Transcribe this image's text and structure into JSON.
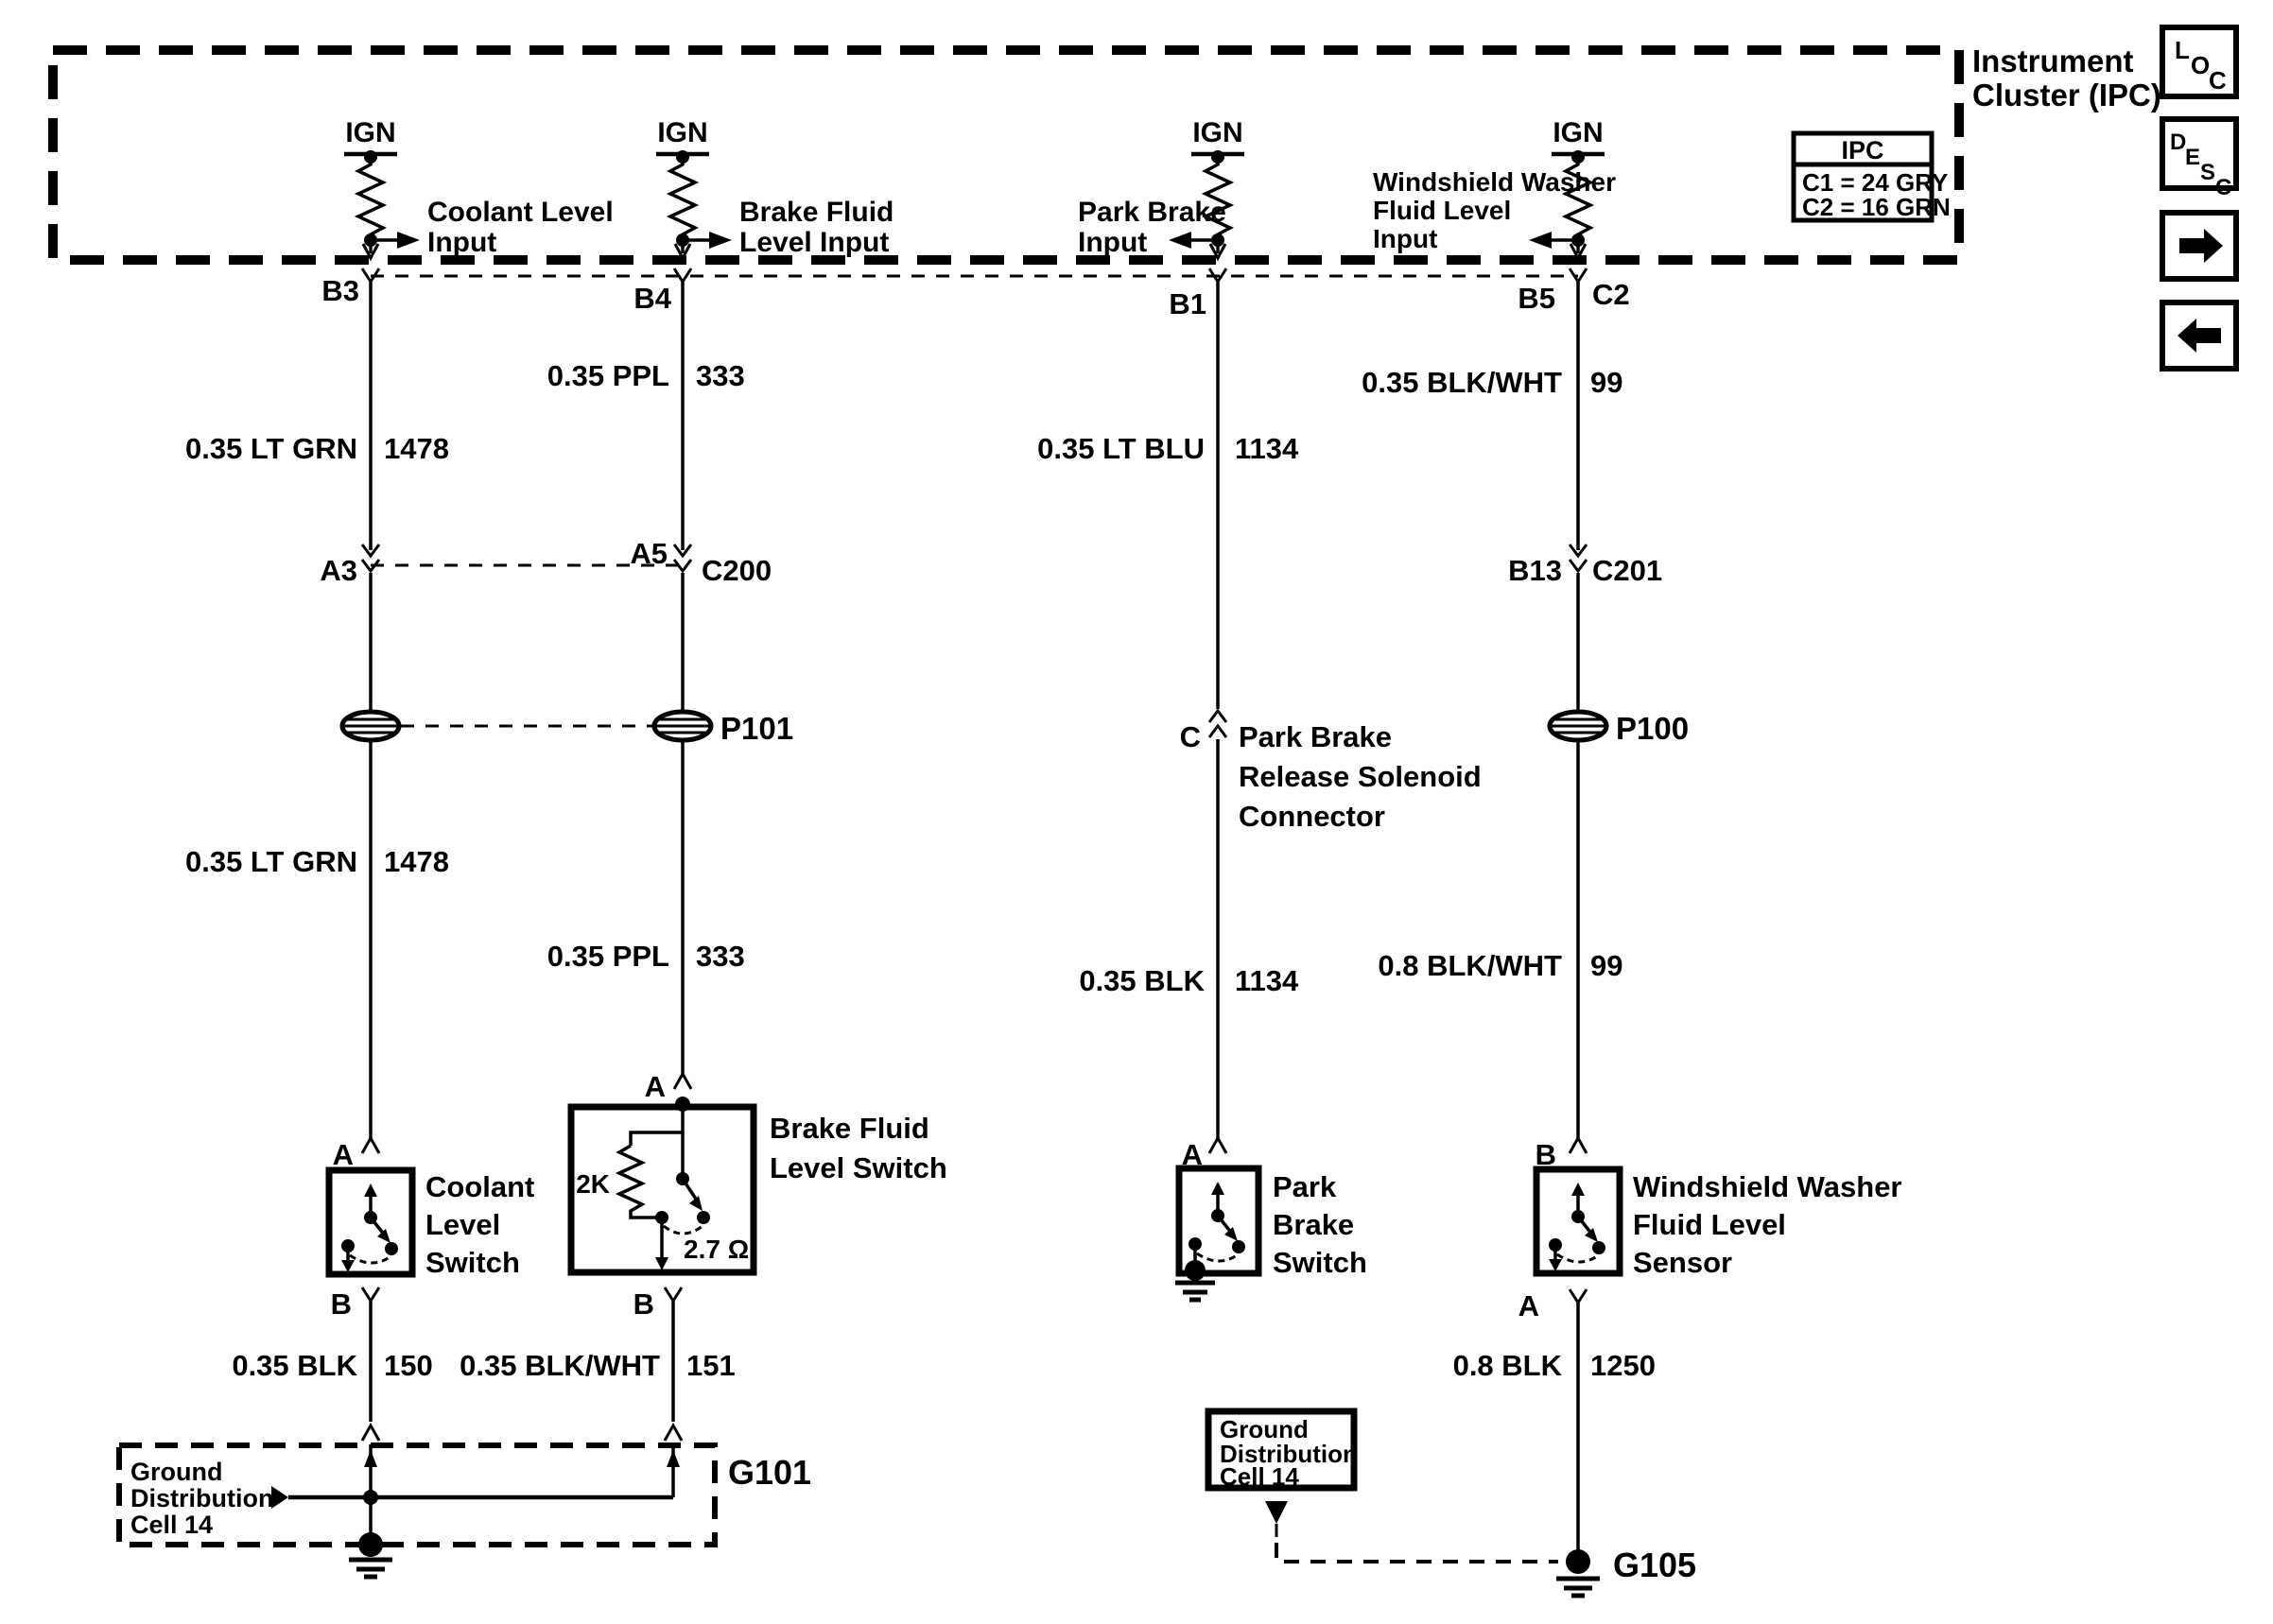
{
  "header": {
    "title_line1": "Instrument",
    "title_line2": "Cluster (IPC)",
    "legend": {
      "title": "IPC",
      "row1": "C1 = 24 GRY",
      "row2": "C2 = 16 GRN"
    },
    "nav": {
      "loc": [
        "L",
        "O",
        "C"
      ],
      "desc": [
        "D",
        "E",
        "S",
        "C"
      ]
    }
  },
  "ipc": {
    "ign": "IGN",
    "inputs": {
      "coolant": [
        "Coolant Level",
        "Input"
      ],
      "brake": [
        "Brake Fluid",
        "Level Input"
      ],
      "park": [
        "Park Brake",
        "Input"
      ],
      "washer": [
        "Windshield Washer",
        "Fluid Level",
        "Input"
      ]
    },
    "pins": {
      "b3": "B3",
      "b4": "B4",
      "b1": "B1",
      "b5": "B5",
      "c2": "C2"
    }
  },
  "wires": {
    "coolant_upper": {
      "spec": "0.35 LT GRN",
      "circuit": "1478"
    },
    "coolant_lower": {
      "spec": "0.35 LT GRN",
      "circuit": "1478"
    },
    "coolant_ground": {
      "spec": "0.35 BLK",
      "circuit": "150"
    },
    "brake_upper": {
      "spec": "0.35 PPL",
      "circuit": "333"
    },
    "brake_lower": {
      "spec": "0.35 PPL",
      "circuit": "333"
    },
    "brake_ground": {
      "spec": "0.35 BLK/WHT",
      "circuit": "151"
    },
    "park_upper": {
      "spec": "0.35 LT BLU",
      "circuit": "1134"
    },
    "park_lower": {
      "spec": "0.35 BLK",
      "circuit": "1134"
    },
    "washer_upper": {
      "spec": "0.35 BLK/WHT",
      "circuit": "99"
    },
    "washer_lower": {
      "spec": "0.8 BLK/WHT",
      "circuit": "99"
    },
    "washer_ground": {
      "spec": "0.8 BLK",
      "circuit": "1250"
    }
  },
  "connectors": {
    "c200": {
      "pin_left": "A3",
      "pin_right": "A5",
      "name": "C200"
    },
    "c201": {
      "pin": "B13",
      "name": "C201"
    },
    "p101": "P101",
    "p100": "P100",
    "solenoid": {
      "pin": "C",
      "name": [
        "Park Brake",
        "Release Solenoid",
        "Connector"
      ]
    },
    "g101": "G101",
    "g105": "G105"
  },
  "components": {
    "coolant": {
      "pin_top": "A",
      "pin_bottom": "B",
      "name": [
        "Coolant",
        "Level",
        "Switch"
      ]
    },
    "brake": {
      "pin_top": "A",
      "pin_bottom": "B",
      "name": [
        "Brake Fluid",
        "Level Switch"
      ],
      "resistor": "2K",
      "contact_resistance": "2.7 Ω"
    },
    "park": {
      "pin_top": "A",
      "name": [
        "Park",
        "Brake",
        "Switch"
      ]
    },
    "washer": {
      "pin_top": "B",
      "pin_bottom": "A",
      "name": [
        "Windshield Washer",
        "Fluid Level",
        "Sensor"
      ]
    }
  },
  "grounds": {
    "note": [
      "Ground",
      "Distribution",
      "Cell 14"
    ]
  }
}
